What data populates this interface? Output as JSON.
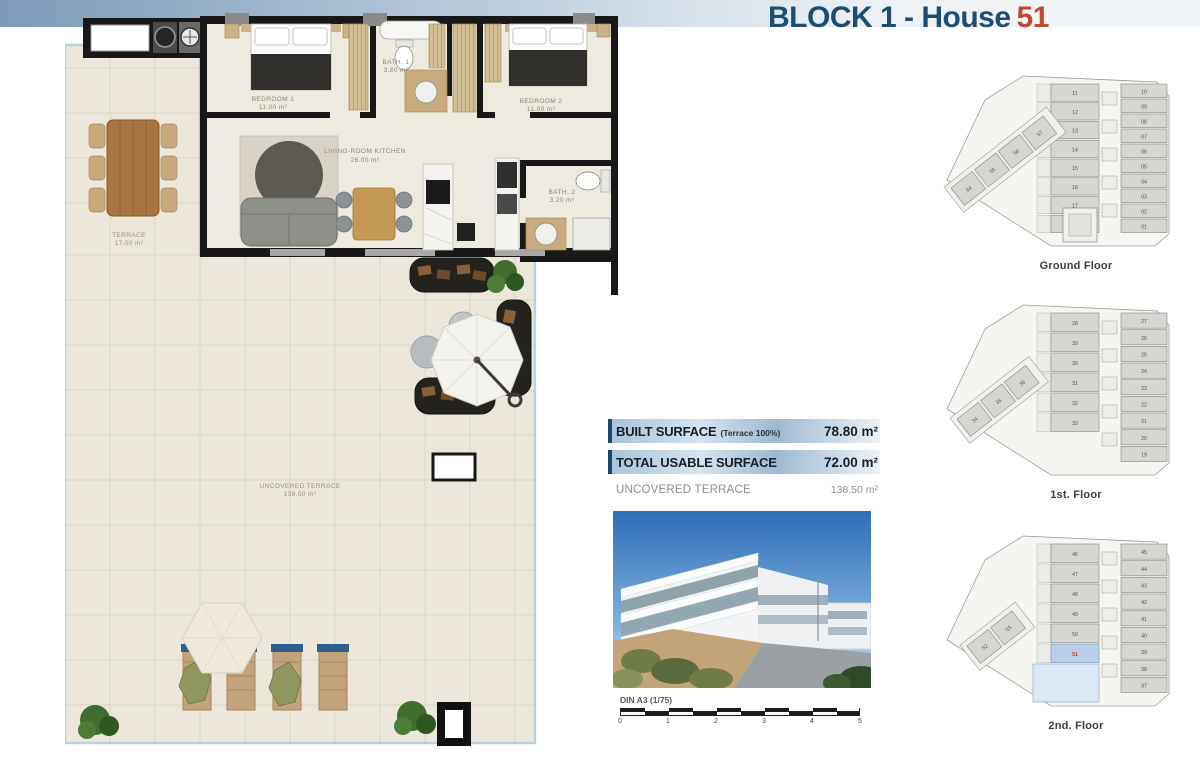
{
  "header": {
    "title_prefix": "BLOCK 1 - House",
    "house_number": "51"
  },
  "floorplan": {
    "rooms": [
      {
        "name": "BEDROOM 1",
        "area": "11.00 m²"
      },
      {
        "name": "BATH. 1",
        "area": "3.80 m²"
      },
      {
        "name": "BEDROOM 2",
        "area": "11.00 m²"
      },
      {
        "name": "LIVING-ROOM KITCHEN",
        "area": "26.00 m²"
      },
      {
        "name": "BATH. 2",
        "area": "3.20 m²"
      },
      {
        "name": "TERRACE",
        "area": "17.00 m²"
      },
      {
        "name": "UNCOVERED TERRACE",
        "area": "138.50 m²"
      }
    ]
  },
  "surface_table": {
    "rows": [
      {
        "label": "BUILT SURFACE",
        "note": "(Terrace 100%)",
        "value": "78.80 m²",
        "style": "hl"
      },
      {
        "label": "TOTAL USABLE SURFACE",
        "note": "",
        "value": "72.00 m²",
        "style": "hl"
      },
      {
        "label": "UNCOVERED TERRACE",
        "note": "",
        "value": "138.50 m²",
        "style": "plain"
      }
    ]
  },
  "scale_bar": {
    "label": "DIN A3 (1/75)",
    "ticks": [
      "0",
      "1",
      "2",
      "3",
      "4",
      "5"
    ]
  },
  "mini_plans": [
    {
      "label": "Ground Floor",
      "left_units": [
        "11",
        "12",
        "13",
        "14",
        "15",
        "16",
        "17",
        "18"
      ],
      "right_units": [
        "10",
        "09",
        "08",
        "07",
        "06",
        "05",
        "04",
        "03",
        "02",
        "01"
      ],
      "annex_units": [
        "54",
        "55",
        "56",
        "57"
      ],
      "highlight_unit": ""
    },
    {
      "label": "1st. Floor",
      "left_units": [
        "28",
        "29",
        "30",
        "31",
        "32",
        "33"
      ],
      "right_units": [
        "27",
        "26",
        "25",
        "24",
        "23",
        "22",
        "21",
        "20",
        "19"
      ],
      "annex_units": [
        "34",
        "35",
        "36"
      ],
      "highlight_unit": ""
    },
    {
      "label": "2nd. Floor",
      "left_units": [
        "46",
        "47",
        "48",
        "49",
        "50",
        "51"
      ],
      "right_units": [
        "45",
        "44",
        "43",
        "42",
        "41",
        "40",
        "39",
        "38",
        "37"
      ],
      "annex_units": [
        "52",
        "53"
      ],
      "highlight_unit": "51"
    }
  ],
  "colors": {
    "accent_navy": "#1c4e74",
    "accent_red": "#c14a2e",
    "highlight_unit_fill": "#b9cfe9",
    "highlight_terrace_fill": "#dce8f5",
    "unit_fill": "#d7d6d2",
    "plan_floor": "#ece7da",
    "wall": "#181818"
  }
}
